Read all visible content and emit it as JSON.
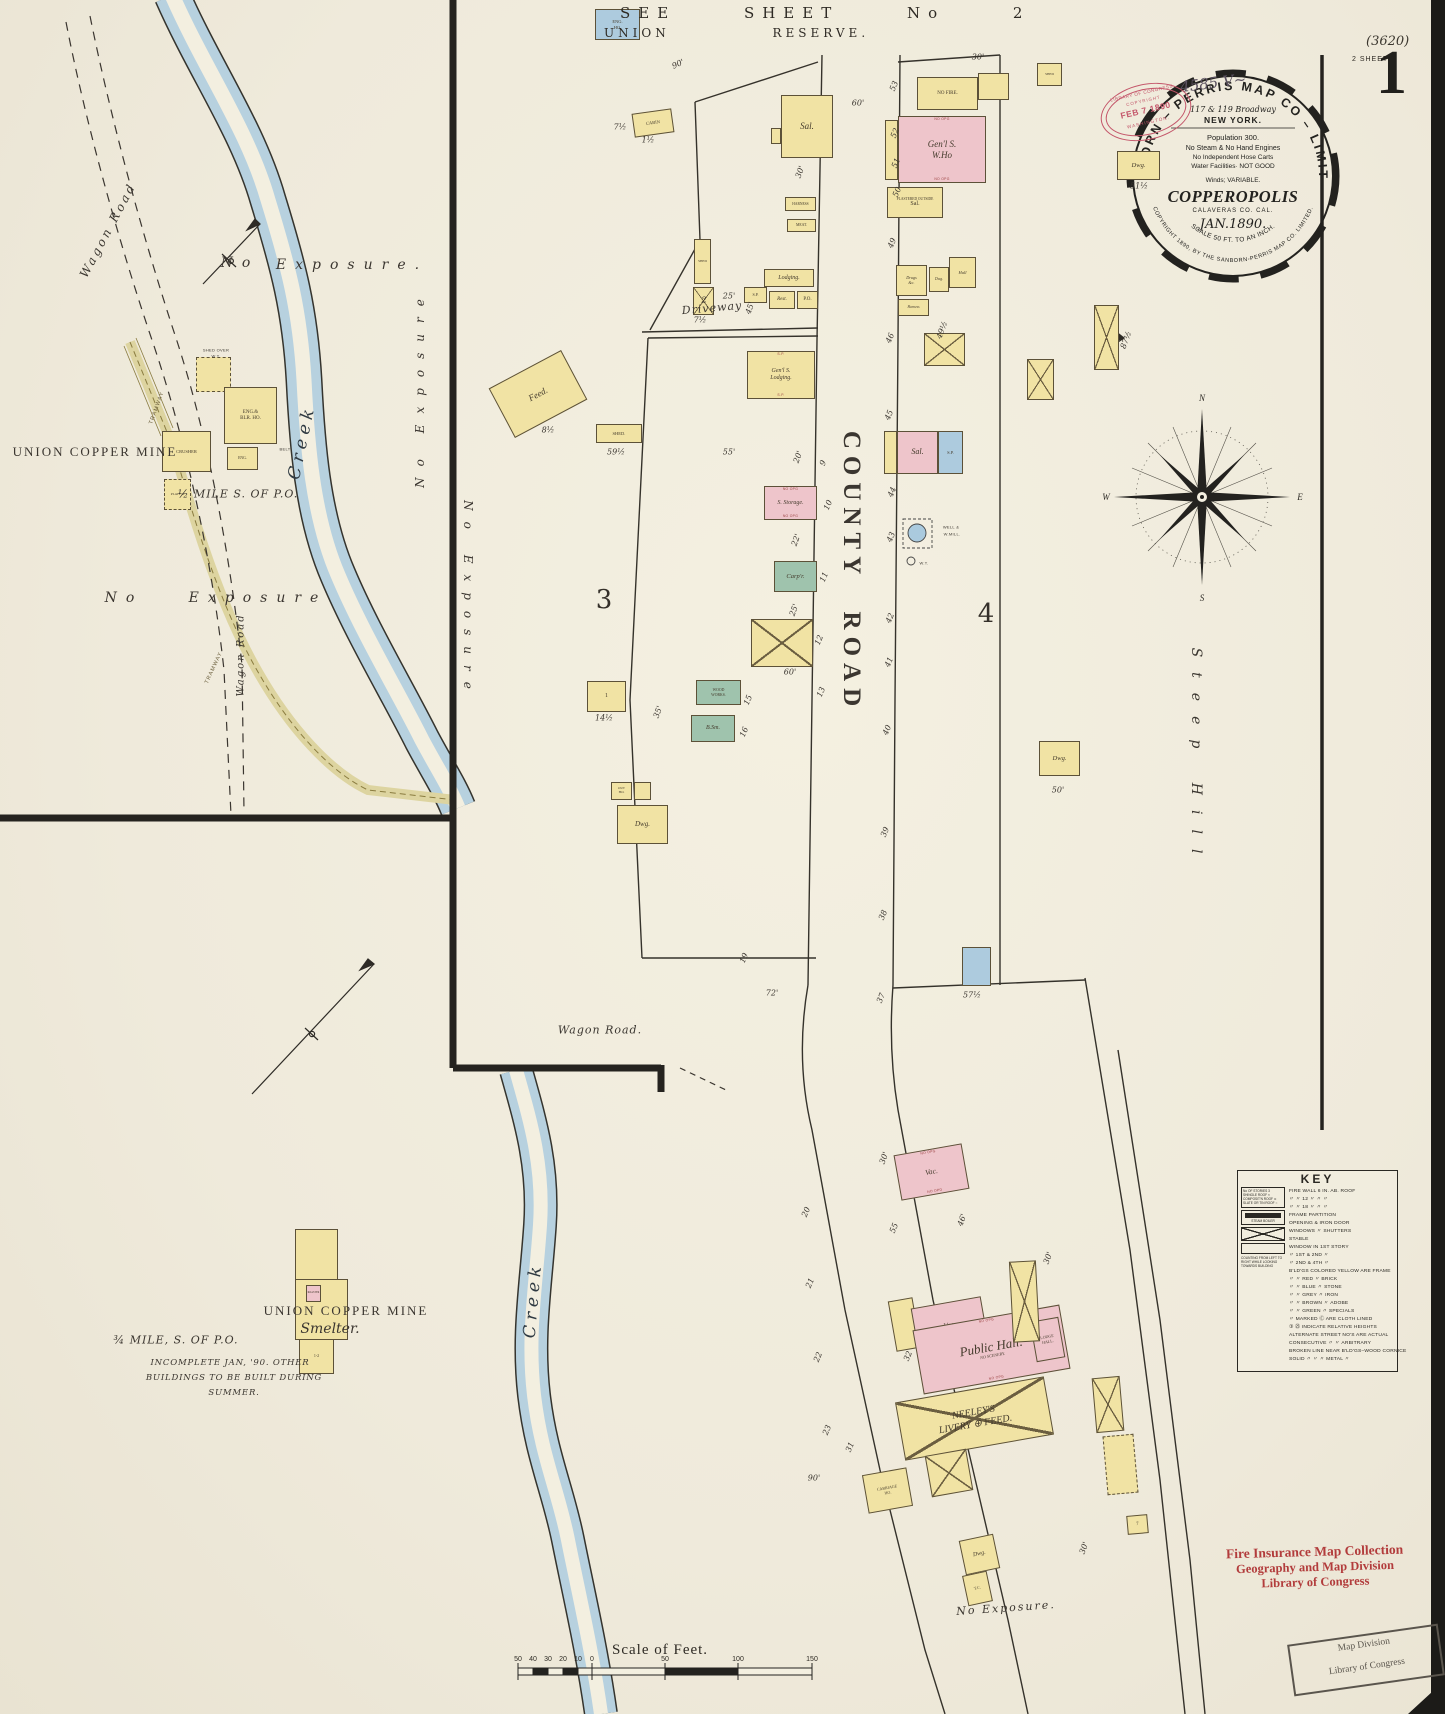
{
  "page": {
    "sheet_number": "1",
    "sheets_note": "2 SHEETS",
    "plate_note": "(3620)",
    "handwritten_id": "4585 V~"
  },
  "header": {
    "see_sheet": "SEE SHEET No 2",
    "union_reserve": "UNION RESERVE."
  },
  "publisher_stamp": {
    "arc_top": "SANBORN – PERRIS MAP CO – LIMITED",
    "address": "117 & 119 Broadway",
    "city": "NEW YORK.",
    "population": "Population 300.",
    "engines": "No Steam & No Hand Engines",
    "hose": "No Independent Hose Carts",
    "water": "Water Facilities· NOT GOOD",
    "winds": "Winds; VARIABLE.",
    "town": "COPPEROPOLIS",
    "county": "CALAVERAS CO.  CAL.",
    "date": "JAN.1890.",
    "scale": "SCALE 50 FT. TO AN INCH.",
    "arc_bottom": "COPYRIGHT 1890, BY THE SANBORN-PERRIS MAP CO. LIMITED."
  },
  "loc_copyright_stamp": {
    "line1": "LIBRARY OF CONGRESS",
    "line2": "COPYRIGHT",
    "line3": "FEB 7 1890",
    "line4": "WASHINGTON."
  },
  "loc_collection_stamp": {
    "line1": "Fire Insurance Map Collection",
    "line2": "Geography and Map Division",
    "line3": "Library of Congress"
  },
  "mapdiv_stamp": {
    "line1": "Map Division",
    "line2": "Library of Congress"
  },
  "compass": {
    "n": "N",
    "s": "S",
    "e": "E",
    "w": "W"
  },
  "key": {
    "title": "KEY",
    "right_lines": [
      "FIRE WALL 6 IN. AB. ROOF",
      "〃   〃   12 〃   〃   〃",
      "〃   〃   18 〃   〃   〃",
      "FRAME PARTITION",
      "OPENING & IRON DOOR",
      "WINDOWS 〃  SHUTTERS",
      "STABLE",
      "WINDOW IN 1ST STORY",
      "〃   1ST & 2ND   〃",
      "〃   2ND & 4TH   〃",
      "B'LD'GS COLORED YELLOW ARE FRAME",
      "〃     〃     RED   〃   BRICK",
      "〃     〃     BLUE   〃   STONE",
      "〃     〃     GREY   〃   IRON",
      "〃     〃     BROWN   〃   ADOBE",
      "〃     〃     GREEN  〃  SPECIALS",
      "〃  MARKED Ⓒ ARE CLOTH LINED",
      "③ ㉕ INDICATE RELATIVE HEIGHTS",
      "ALTERNATE STREET NO'S ARE ACTUAL",
      "CONSECUTIVE  〃   〃  ARBITRARY",
      "BROKEN LINE NEAR B'LD'GS–WOOD CORNICE",
      "SOLID   〃    〃    〃   METAL   〃"
    ],
    "left_items": [
      "No OF STORIES 3",
      "SHINGLE ROOF ×",
      "COMPOSIT'N ROOF ⊙",
      "SLATE OR TIN ROOF ○",
      "STEAM BOILER",
      "COUNTING FROM LEFT TO RIGHT WHILE LOOKING TOWARDS BUILDING"
    ]
  },
  "scale_bar": {
    "caption": "Scale of Feet.",
    "labels": [
      {
        "t": "50",
        "x": 518
      },
      {
        "t": "40",
        "x": 533
      },
      {
        "t": "30",
        "x": 548
      },
      {
        "t": "20",
        "x": 563
      },
      {
        "t": "10",
        "x": 578
      },
      {
        "t": "0",
        "x": 592
      },
      {
        "t": "50",
        "x": 665
      },
      {
        "t": "100",
        "x": 738
      },
      {
        "t": "150",
        "x": 812
      }
    ]
  },
  "block_numbers": [
    {
      "t": "3",
      "x": 604,
      "y": 600
    },
    {
      "t": "4",
      "x": 986,
      "y": 614
    }
  ],
  "map_labels": [
    {
      "t": "Wagon Road",
      "x": 108,
      "y": 230,
      "r": -62,
      "cls": "rd"
    },
    {
      "t": "No",
      "x": 240,
      "y": 263,
      "cls": "exp"
    },
    {
      "t": "Exposure.",
      "x": 352,
      "y": 265,
      "cls": "exp"
    },
    {
      "t": "No Exposure",
      "x": 420,
      "y": 388,
      "r": -90,
      "cls": "exp-sp"
    },
    {
      "t": "Creek",
      "x": 302,
      "y": 442,
      "r": -78,
      "cls": "creek"
    },
    {
      "t": "UNION COPPER MINE",
      "x": 95,
      "y": 452,
      "cls": "mine"
    },
    {
      "t": "½ MILE S. OF P.O.",
      "x": 238,
      "y": 494,
      "cls": "hand"
    },
    {
      "t": "No",
      "x": 124,
      "y": 598,
      "cls": "exp"
    },
    {
      "t": "Exposure",
      "x": 258,
      "y": 598,
      "cls": "exp"
    },
    {
      "t": "Wagon Road",
      "x": 241,
      "y": 655,
      "r": -90,
      "cls": "rd-sm"
    },
    {
      "t": "TRAMWAY",
      "x": 157,
      "y": 408,
      "r": -70,
      "cls": "tiny-rot"
    },
    {
      "t": "TRAMWAY",
      "x": 214,
      "y": 668,
      "r": -65,
      "cls": "tiny-rot"
    },
    {
      "t": "SHED OVER",
      "x": 216,
      "y": 350,
      "cls": "t4"
    },
    {
      "t": "W.T.",
      "x": 216,
      "y": 356,
      "cls": "t4"
    },
    {
      "t": "BELT",
      "x": 285,
      "y": 449,
      "cls": "t4"
    },
    {
      "t": "UNION COPPER MINE",
      "x": 346,
      "y": 1311,
      "cls": "mine"
    },
    {
      "t": "Smelter.",
      "x": 330,
      "y": 1329,
      "cls": "hand-lg"
    },
    {
      "t": "¾ MILE, S. OF P.O.",
      "x": 176,
      "y": 1340,
      "cls": "hand"
    },
    {
      "t": "INCOMPLETE JAN, '90. OTHER",
      "x": 230,
      "y": 1363,
      "cls": "hand-sm"
    },
    {
      "t": "BUILDINGS TO BE BUILT DURING",
      "x": 234,
      "y": 1378,
      "cls": "hand-sm"
    },
    {
      "t": "SUMMER.",
      "x": 234,
      "y": 1393,
      "cls": "hand-sm"
    },
    {
      "t": "Creek",
      "x": 533,
      "y": 1300,
      "r": -85,
      "cls": "creek"
    },
    {
      "t": "Driveway",
      "x": 712,
      "y": 308,
      "r": -5,
      "cls": "ital"
    },
    {
      "t": "Wagon Road.",
      "x": 600,
      "y": 1030,
      "cls": "ital"
    },
    {
      "t": "No Exposure",
      "x": 468,
      "y": 600,
      "r": 90,
      "cls": "exp-sp"
    },
    {
      "t": "COUNTY ROAD",
      "x": 851,
      "y": 572,
      "r": 90,
      "cls": "road-big"
    },
    {
      "t": "Steep Hill",
      "x": 1196,
      "y": 758,
      "r": 90,
      "cls": "hill"
    },
    {
      "t": "No Exposure.",
      "x": 1006,
      "y": 1608,
      "r": -4,
      "cls": "exp-sm"
    },
    {
      "t": "WELL &",
      "x": 951,
      "y": 527,
      "cls": "t4"
    },
    {
      "t": "W.MILL.",
      "x": 952,
      "y": 534,
      "cls": "t4"
    },
    {
      "t": "W.T.",
      "x": 924,
      "y": 563,
      "cls": "t4"
    }
  ],
  "lot_numbers": [
    {
      "t": "53",
      "x": 894,
      "y": 86
    },
    {
      "t": "52",
      "x": 895,
      "y": 133
    },
    {
      "t": "51",
      "x": 896,
      "y": 163
    },
    {
      "t": "50",
      "x": 897,
      "y": 192
    },
    {
      "t": "49",
      "x": 892,
      "y": 243
    },
    {
      "t": "46",
      "x": 890,
      "y": 338
    },
    {
      "t": "45",
      "x": 889,
      "y": 415
    },
    {
      "t": "44",
      "x": 892,
      "y": 492
    },
    {
      "t": "43",
      "x": 891,
      "y": 537
    },
    {
      "t": "42",
      "x": 890,
      "y": 618
    },
    {
      "t": "41",
      "x": 889,
      "y": 662
    },
    {
      "t": "40",
      "x": 887,
      "y": 730
    },
    {
      "t": "39",
      "x": 885,
      "y": 832
    },
    {
      "t": "38",
      "x": 883,
      "y": 915
    },
    {
      "t": "37",
      "x": 881,
      "y": 998
    },
    {
      "t": "2",
      "x": 704,
      "y": 300,
      "r": 0
    },
    {
      "t": "9",
      "x": 823,
      "y": 463
    },
    {
      "t": "10",
      "x": 828,
      "y": 505
    },
    {
      "t": "11",
      "x": 824,
      "y": 577
    },
    {
      "t": "12",
      "x": 819,
      "y": 640
    },
    {
      "t": "13",
      "x": 821,
      "y": 692
    },
    {
      "t": "15",
      "x": 748,
      "y": 700
    },
    {
      "t": "16",
      "x": 744,
      "y": 732
    },
    {
      "t": "19",
      "x": 744,
      "y": 958
    },
    {
      "t": "20",
      "x": 806,
      "y": 1212
    },
    {
      "t": "21",
      "x": 810,
      "y": 1283
    },
    {
      "t": "22",
      "x": 818,
      "y": 1357
    },
    {
      "t": "23",
      "x": 827,
      "y": 1430
    },
    {
      "t": "55",
      "x": 894,
      "y": 1228
    },
    {
      "t": "31",
      "x": 850,
      "y": 1447
    },
    {
      "t": "32",
      "x": 908,
      "y": 1356
    }
  ],
  "dimensions": [
    {
      "t": "90'",
      "x": 678,
      "y": 64,
      "r": -25
    },
    {
      "t": "60'",
      "x": 858,
      "y": 103,
      "r": 0
    },
    {
      "t": "30'",
      "x": 978,
      "y": 57,
      "r": 0
    },
    {
      "t": "30'",
      "x": 800,
      "y": 172,
      "r": -70
    },
    {
      "t": "25'",
      "x": 729,
      "y": 296,
      "r": 0
    },
    {
      "t": "7½",
      "x": 700,
      "y": 320,
      "r": 0
    },
    {
      "t": "1½",
      "x": 648,
      "y": 140,
      "r": 0
    },
    {
      "t": "45'",
      "x": 750,
      "y": 308,
      "r": -70
    },
    {
      "t": "55'",
      "x": 729,
      "y": 452,
      "r": 0
    },
    {
      "t": "20'",
      "x": 798,
      "y": 457,
      "r": -70
    },
    {
      "t": "22'",
      "x": 796,
      "y": 540,
      "r": -70
    },
    {
      "t": "25'",
      "x": 794,
      "y": 610,
      "r": -70
    },
    {
      "t": "35'",
      "x": 658,
      "y": 712,
      "r": -70
    },
    {
      "t": "14½",
      "x": 604,
      "y": 718,
      "r": 0
    },
    {
      "t": "59½",
      "x": 616,
      "y": 452,
      "r": 0
    },
    {
      "t": "8½",
      "x": 548,
      "y": 430,
      "r": 0
    },
    {
      "t": "60'",
      "x": 790,
      "y": 672,
      "r": 0
    },
    {
      "t": "72'",
      "x": 772,
      "y": 993,
      "r": 0
    },
    {
      "t": "49½",
      "x": 942,
      "y": 330,
      "r": -70
    },
    {
      "t": "87½",
      "x": 1126,
      "y": 340,
      "r": -70
    },
    {
      "t": "51½",
      "x": 1139,
      "y": 186,
      "r": 0
    },
    {
      "t": "57½",
      "x": 972,
      "y": 995,
      "r": 0
    },
    {
      "t": "50'",
      "x": 1058,
      "y": 790,
      "r": 0
    },
    {
      "t": "30'",
      "x": 1048,
      "y": 1258,
      "r": -70
    },
    {
      "t": "30'",
      "x": 1084,
      "y": 1548,
      "r": -70
    },
    {
      "t": "46'",
      "x": 962,
      "y": 1220,
      "r": -70
    },
    {
      "t": "30'",
      "x": 884,
      "y": 1158,
      "r": -70
    },
    {
      "t": "90'",
      "x": 814,
      "y": 1478,
      "r": 0
    },
    {
      "t": "7½",
      "x": 620,
      "y": 127,
      "r": 0
    }
  ],
  "buildings": [
    {
      "x": 633,
      "y": 111,
      "w": 40,
      "h": 24,
      "r": -8,
      "c": "y",
      "l1": "CABIN",
      "fs": 4.5
    },
    {
      "x": 781,
      "y": 95,
      "w": 52,
      "h": 63,
      "c": "y",
      "l1": "Sal.",
      "fs": 9,
      "it": 1
    },
    {
      "x": 771,
      "y": 128,
      "w": 10,
      "h": 16,
      "c": "y"
    },
    {
      "x": 785,
      "y": 197,
      "w": 31,
      "h": 14,
      "c": "y",
      "l1": "HARNESS",
      "fs": 3.6
    },
    {
      "x": 787,
      "y": 219,
      "w": 29,
      "h": 13,
      "c": "y",
      "l1": "MEAT.",
      "fs": 3.8
    },
    {
      "x": 694,
      "y": 239,
      "w": 17,
      "h": 45,
      "c": "y",
      "l1": "SHED",
      "fs": 3.4
    },
    {
      "x": 693,
      "y": 287,
      "w": 21,
      "h": 28,
      "c": "y",
      "cross": 1,
      "l1": "2",
      "fs": 6
    },
    {
      "x": 744,
      "y": 287,
      "w": 23,
      "h": 16,
      "c": "y",
      "l1": "S.P.",
      "fs": 4
    },
    {
      "x": 764,
      "y": 269,
      "w": 50,
      "h": 18,
      "c": "y",
      "l1": "Lodging.",
      "fs": 6,
      "it": 1
    },
    {
      "x": 769,
      "y": 291,
      "w": 26,
      "h": 18,
      "c": "y",
      "l1": "Rest.",
      "fs": 5,
      "it": 1
    },
    {
      "x": 797,
      "y": 291,
      "w": 21,
      "h": 18,
      "c": "y",
      "l1": "P.O.",
      "fs": 5
    },
    {
      "x": 497,
      "y": 366,
      "w": 82,
      "h": 56,
      "r": -28,
      "c": "y",
      "l1": "Feed.",
      "fs": 9,
      "it": 1
    },
    {
      "x": 596,
      "y": 424,
      "w": 46,
      "h": 19,
      "c": "y",
      "l1": "SHED.",
      "fs": 4.5
    },
    {
      "x": 747,
      "y": 351,
      "w": 68,
      "h": 48,
      "c": "y",
      "l1": "Gen'l S.",
      "l2": "Lodging.",
      "fs": 6,
      "it": 1,
      "tm": "S.P.",
      "bm": "S.P."
    },
    {
      "x": 764,
      "y": 486,
      "w": 53,
      "h": 34,
      "c": "p",
      "l1": "S. Storage.",
      "fs": 6,
      "it": 1,
      "tm": "NO OPG",
      "bm": "NO OPG"
    },
    {
      "x": 774,
      "y": 561,
      "w": 43,
      "h": 31,
      "c": "g",
      "l1": "Carp'r.",
      "fs": 6.5,
      "it": 1
    },
    {
      "x": 751,
      "y": 619,
      "w": 62,
      "h": 48,
      "c": "y",
      "cross": 1
    },
    {
      "x": 587,
      "y": 681,
      "w": 39,
      "h": 31,
      "c": "y",
      "l1": "1",
      "fs": 6
    },
    {
      "x": 696,
      "y": 680,
      "w": 45,
      "h": 25,
      "c": "g",
      "l1": "WOOD",
      "l2": "WORKS.",
      "fs": 3.8
    },
    {
      "x": 691,
      "y": 715,
      "w": 44,
      "h": 27,
      "c": "g",
      "l1": "B.Sm.",
      "fs": 6,
      "it": 1
    },
    {
      "x": 611,
      "y": 782,
      "w": 21,
      "h": 18,
      "c": "y",
      "l1": "OUT",
      "l2": "HO.",
      "fs": 3.4
    },
    {
      "x": 634,
      "y": 782,
      "w": 17,
      "h": 18,
      "c": "y"
    },
    {
      "x": 617,
      "y": 805,
      "w": 51,
      "h": 39,
      "c": "y",
      "l1": "Dwg.",
      "fs": 7,
      "it": 1
    },
    {
      "x": 917,
      "y": 77,
      "w": 61,
      "h": 33,
      "c": "y",
      "l1": "NO FIRE.",
      "fs": 5
    },
    {
      "x": 978,
      "y": 73,
      "w": 31,
      "h": 27,
      "c": "y"
    },
    {
      "x": 1037,
      "y": 63,
      "w": 25,
      "h": 23,
      "c": "y",
      "l1": "SHED",
      "fs": 3.4
    },
    {
      "x": 885,
      "y": 120,
      "w": 13,
      "h": 60,
      "c": "y"
    },
    {
      "x": 898,
      "y": 116,
      "w": 88,
      "h": 67,
      "c": "p",
      "l1": "Gen'l S.",
      "l2": "W.Ho",
      "fs": 9,
      "it": 1,
      "tm": "NO OPG",
      "bm": "NO OPG"
    },
    {
      "x": 887,
      "y": 187,
      "w": 56,
      "h": 31,
      "c": "y",
      "l1": "PLASTERED OUTSIDE",
      "l2": "Sal.",
      "fs": 3.6,
      "l2fs": 6
    },
    {
      "x": 1117,
      "y": 151,
      "w": 43,
      "h": 29,
      "c": "y",
      "l1": "Dwg.",
      "fs": 6.5,
      "it": 1
    },
    {
      "x": 949,
      "y": 257,
      "w": 27,
      "h": 31,
      "c": "y",
      "l1": "Hall",
      "fs": 4.5,
      "it": 1
    },
    {
      "x": 896,
      "y": 265,
      "w": 31,
      "h": 31,
      "c": "y",
      "l1": "Drugs",
      "l2": "&c.",
      "fs": 4.2,
      "it": 1
    },
    {
      "x": 929,
      "y": 267,
      "w": 20,
      "h": 25,
      "c": "y",
      "l1": "Dwg.",
      "fs": 3.8,
      "it": 1
    },
    {
      "x": 898,
      "y": 299,
      "w": 31,
      "h": 17,
      "c": "y",
      "l1": "Harness",
      "fs": 3.6,
      "it": 1
    },
    {
      "x": 924,
      "y": 333,
      "w": 41,
      "h": 33,
      "c": "y",
      "cross": 1
    },
    {
      "x": 1094,
      "y": 305,
      "w": 25,
      "h": 65,
      "c": "y",
      "cross": 1
    },
    {
      "x": 1027,
      "y": 359,
      "w": 27,
      "h": 41,
      "c": "y",
      "cross": 1
    },
    {
      "x": 884,
      "y": 431,
      "w": 13,
      "h": 43,
      "c": "y"
    },
    {
      "x": 897,
      "y": 431,
      "w": 41,
      "h": 43,
      "c": "p",
      "l1": "Sal.",
      "fs": 8,
      "it": 1
    },
    {
      "x": 938,
      "y": 431,
      "w": 25,
      "h": 43,
      "c": "b",
      "l1": "S.P.",
      "fs": 4.5
    },
    {
      "x": 1039,
      "y": 741,
      "w": 41,
      "h": 35,
      "c": "y",
      "l1": "Dwg.",
      "fs": 6.5,
      "it": 1
    },
    {
      "x": 962,
      "y": 947,
      "w": 29,
      "h": 39,
      "c": "b"
    },
    {
      "x": 897,
      "y": 1149,
      "w": 69,
      "h": 46,
      "r": -10,
      "c": "p",
      "l1": "Vac.",
      "fs": 7.5,
      "it": 1,
      "tm": "NO OPG",
      "bm": "NO OPG"
    },
    {
      "x": 892,
      "y": 1299,
      "w": 25,
      "h": 51,
      "r": -10,
      "c": "y"
    },
    {
      "x": 915,
      "y": 1302,
      "w": 71,
      "h": 56,
      "r": -10,
      "c": "p",
      "l1": "Vac.",
      "l2": "Sal.",
      "fs": 7,
      "it": 1,
      "bm": "NO OPG"
    },
    {
      "x": 917,
      "y": 1317,
      "w": 149,
      "h": 65,
      "r": -10,
      "c": "p",
      "l1": "Public Hall.",
      "l2": "NO SCENERY.",
      "fs": 13,
      "l2fs": 4.2,
      "it": 1,
      "tm": "NO OPG",
      "bm": "NO OPG"
    },
    {
      "x": 1033,
      "y": 1319,
      "w": 29,
      "h": 41,
      "r": -10,
      "c": "p",
      "l1": "LODGE",
      "l2": "HALL.",
      "fs": 4
    },
    {
      "x": 899,
      "y": 1389,
      "w": 151,
      "h": 59,
      "r": -10,
      "c": "y",
      "cross": 1,
      "l1": "NEELEY'S",
      "l2": "LIVERY ⊕ FEED.",
      "fs": 10,
      "it": 1
    },
    {
      "x": 928,
      "y": 1452,
      "w": 42,
      "h": 42,
      "r": -10,
      "c": "y",
      "cross": 1
    },
    {
      "x": 865,
      "y": 1471,
      "w": 45,
      "h": 39,
      "r": -10,
      "c": "y",
      "l1": "CARRIAGE",
      "l2": "HO.",
      "fs": 4
    },
    {
      "x": 1011,
      "y": 1261,
      "w": 27,
      "h": 81,
      "r": -3,
      "c": "y",
      "cross": 1
    },
    {
      "x": 1094,
      "y": 1377,
      "w": 28,
      "h": 55,
      "r": -5,
      "c": "y",
      "cross": 1
    },
    {
      "x": 1105,
      "y": 1435,
      "w": 31,
      "h": 59,
      "r": -5,
      "c": "y",
      "dash": 1
    },
    {
      "x": 1127,
      "y": 1515,
      "w": 21,
      "h": 19,
      "r": -5,
      "c": "y",
      "l1": "7",
      "fs": 5
    },
    {
      "x": 962,
      "y": 1537,
      "w": 35,
      "h": 35,
      "r": -12,
      "c": "y",
      "l1": "Dwg.",
      "fs": 6,
      "it": 1
    },
    {
      "x": 965,
      "y": 1573,
      "w": 25,
      "h": 31,
      "r": -12,
      "c": "y",
      "l1": "T.C.",
      "fs": 4
    },
    {
      "x": 196,
      "y": 357,
      "w": 35,
      "h": 35,
      "c": "y",
      "dash": 1
    },
    {
      "x": 224,
      "y": 387,
      "w": 53,
      "h": 57,
      "c": "y",
      "l1": "ENG.&",
      "l2": "BLR. HO.",
      "fs": 5
    },
    {
      "x": 227,
      "y": 447,
      "w": 31,
      "h": 23,
      "c": "y",
      "l1": "ENG.",
      "fs": 3.8
    },
    {
      "x": 162,
      "y": 431,
      "w": 49,
      "h": 41,
      "c": "y",
      "l1": "CRUSHER",
      "fs": 4.5
    },
    {
      "x": 164,
      "y": 479,
      "w": 27,
      "h": 31,
      "c": "y",
      "dash": 1,
      "l1": "PLATF'M",
      "fs": 3.4
    },
    {
      "x": 295,
      "y": 1229,
      "w": 43,
      "h": 51,
      "c": "y"
    },
    {
      "x": 295,
      "y": 1279,
      "w": 53,
      "h": 61,
      "c": "y"
    },
    {
      "x": 306,
      "y": 1285,
      "w": 15,
      "h": 17,
      "c": "p",
      "l1": "ROASTER",
      "fs": 2.6
    },
    {
      "x": 299,
      "y": 1339,
      "w": 35,
      "h": 35,
      "c": "y",
      "l1": "1-2",
      "fs": 4
    },
    {
      "x": 595,
      "y": 9,
      "w": 45,
      "h": 31,
      "c": "b",
      "l1": "ENG.",
      "l2": "HO.",
      "fs": 4.5
    }
  ]
}
